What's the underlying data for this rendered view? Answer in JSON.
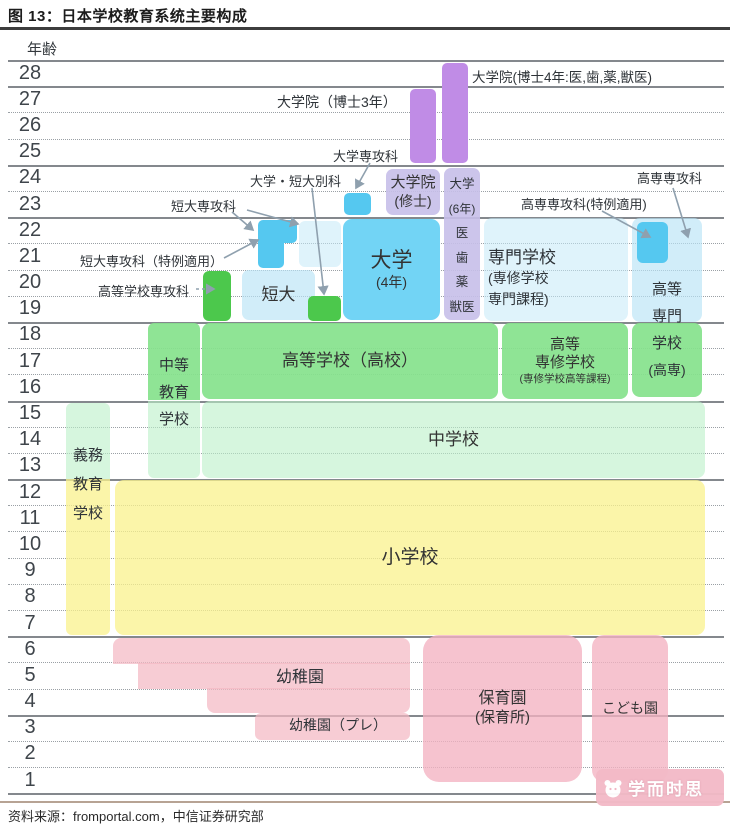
{
  "title": "图 13：日本学校教育系统主要构成",
  "source": "资料来源：fromportal.com，中信证券研究部",
  "axis_label": "年齢",
  "watermark": "学而时思",
  "diagram": {
    "palette": {
      "purple": "#c08ce6",
      "lavender": "rgba(198,191,233,0.9)",
      "blue": "#72d4f5",
      "blue_deep": "#55c8f0",
      "blue_pale": "rgba(184,228,246,0.65)",
      "blue_paler": "rgba(196,233,248,0.55)",
      "green_bright": "#4cc84c",
      "green_mid": "rgba(134,226,140,0.92)",
      "green_pale": "rgba(186,240,200,0.6)",
      "yellow": "rgba(250,242,140,0.75)",
      "pink": "rgba(244,184,196,0.72)",
      "pink2": "rgba(243,178,194,0.78)",
      "arrow": "#8fa0ae",
      "text": "#2e3338"
    },
    "rows": {
      "top": 60,
      "height": 26.19,
      "count": 28,
      "x1": 8,
      "x2": 724,
      "solid": [
        0,
        1,
        4,
        6,
        10,
        13,
        16,
        22,
        25,
        28
      ],
      "ages": [
        28,
        27,
        26,
        25,
        24,
        23,
        22,
        21,
        20,
        19,
        18,
        17,
        16,
        15,
        14,
        13,
        12,
        11,
        10,
        9,
        8,
        7,
        6,
        5,
        4,
        3,
        2,
        1
      ]
    },
    "blocks": [
      {
        "n": "block-doctoral-4yr",
        "x": 442,
        "y": 63,
        "w": 26,
        "h": 100,
        "c": "purple",
        "r": "5px"
      },
      {
        "n": "block-doctoral-3yr",
        "x": 410,
        "y": 89,
        "w": 26,
        "h": 74,
        "c": "purple",
        "r": "5px"
      },
      {
        "n": "block-grad-master",
        "x": 386,
        "y": 169,
        "w": 54,
        "h": 46,
        "c": "lavender",
        "r": "7px",
        "lines": [
          [
            "大学院",
            15
          ],
          [
            "(修士)",
            14
          ]
        ]
      },
      {
        "n": "block-univ-6yr",
        "x": 444,
        "y": 168,
        "w": 36,
        "h": 152,
        "c": "lavender",
        "r": "7px"
      },
      {
        "n": "block-univ-senkoka",
        "x": 344,
        "y": 193,
        "w": 27,
        "h": 22,
        "c": "blue_deep",
        "r": "5px"
      },
      {
        "n": "block-univ-4yr",
        "x": 343,
        "y": 219,
        "w": 97,
        "h": 101,
        "c": "blue",
        "r": "9px",
        "lines": [
          [
            "大学",
            21
          ],
          [
            "(4年)",
            14
          ]
        ]
      },
      {
        "n": "block-tandai-senkoka-upper",
        "x": 258,
        "y": 220,
        "w": 39,
        "h": 23,
        "c": "blue_deep",
        "r": "5px 5px 5px 0"
      },
      {
        "n": "block-tandai-senkoka-lower",
        "x": 258,
        "y": 242,
        "w": 26,
        "h": 26,
        "c": "blue_deep",
        "r": "0 0 5px 5px"
      },
      {
        "n": "block-univ-haze",
        "x": 299,
        "y": 221,
        "w": 42,
        "h": 46,
        "c": "blue_paler",
        "r": "6px"
      },
      {
        "n": "block-tandai",
        "x": 242,
        "y": 270,
        "w": 73,
        "h": 50,
        "c": "blue_pale",
        "r": "7px",
        "lines": [
          [
            "短大",
            17
          ]
        ]
      },
      {
        "n": "block-bekka-green",
        "x": 308,
        "y": 296,
        "w": 33,
        "h": 25,
        "c": "green_bright",
        "r": "5px"
      },
      {
        "n": "block-koko-senkoka-green",
        "x": 203,
        "y": 271,
        "w": 28,
        "h": 50,
        "c": "green_bright",
        "r": "6px"
      },
      {
        "n": "block-senmon-gakko",
        "x": 484,
        "y": 218,
        "w": 144,
        "h": 103,
        "c": "blue_paler",
        "r": "8px"
      },
      {
        "n": "block-kosen-upper",
        "x": 632,
        "y": 218,
        "w": 70,
        "h": 104,
        "c": "blue_pale",
        "r": "8px"
      },
      {
        "n": "block-kosen-senkoka",
        "x": 637,
        "y": 222,
        "w": 31,
        "h": 41,
        "c": "blue_deep",
        "r": "6px"
      },
      {
        "n": "block-kosen-green",
        "x": 632,
        "y": 323,
        "w": 70,
        "h": 74,
        "c": "green_mid",
        "r": "8px"
      },
      {
        "n": "block-chuto-upper",
        "x": 148,
        "y": 323,
        "w": 52,
        "h": 77,
        "c": "green_mid",
        "r": "6px 6px 0 0"
      },
      {
        "n": "block-chuto-lower",
        "x": 148,
        "y": 401,
        "w": 52,
        "h": 77,
        "c": "green_pale",
        "r": "0 0 6px 6px"
      },
      {
        "n": "block-koko",
        "x": 202,
        "y": 323,
        "w": 296,
        "h": 76,
        "c": "green_mid",
        "r": "8px",
        "lines": [
          [
            "高等学校（高校）",
            17
          ]
        ]
      },
      {
        "n": "block-koto-senshu",
        "x": 502,
        "y": 323,
        "w": 126,
        "h": 76,
        "c": "green_mid",
        "r": "8px",
        "lines": [
          [
            "高等",
            15
          ],
          [
            "専修学校",
            15
          ],
          [
            "(専修学校高等課程)",
            10.5
          ]
        ]
      },
      {
        "n": "block-chugakko",
        "x": 202,
        "y": 401,
        "w": 503,
        "h": 77,
        "c": "green_pale",
        "r": "8px",
        "lines": [
          [
            "中学校",
            17
          ]
        ]
      },
      {
        "n": "block-gimu-upper",
        "x": 66,
        "y": 403,
        "w": 44,
        "h": 76,
        "c": "green_pale",
        "r": "6px 6px 0 0"
      },
      {
        "n": "block-gimu-lower",
        "x": 66,
        "y": 479,
        "w": 44,
        "h": 156,
        "c": "yellow",
        "r": "0 0 6px 6px"
      },
      {
        "n": "block-shogakko",
        "x": 115,
        "y": 480,
        "w": 590,
        "h": 155,
        "c": "yellow",
        "r": "9px",
        "lines": [
          [
            "小学校",
            19
          ]
        ]
      },
      {
        "n": "block-yochien-row6",
        "x": 113,
        "y": 638,
        "w": 297,
        "h": 26,
        "c": "pink",
        "r": "8px 8px 0 0"
      },
      {
        "n": "block-yochien-row5",
        "x": 138,
        "y": 663,
        "w": 272,
        "h": 26,
        "c": "pink",
        "r": "0"
      },
      {
        "n": "block-yochien-row4",
        "x": 207,
        "y": 688,
        "w": 203,
        "h": 25,
        "c": "pink",
        "r": "0 0 8px 8px"
      },
      {
        "n": "block-yochien-pre",
        "x": 255,
        "y": 713,
        "w": 155,
        "h": 27,
        "c": "pink",
        "r": "6px"
      },
      {
        "n": "block-hoikuen",
        "x": 423,
        "y": 635,
        "w": 159,
        "h": 147,
        "c": "pink2",
        "r": "16px",
        "lines": [
          [
            "保育園",
            16
          ],
          [
            "(保育所)",
            15
          ]
        ]
      },
      {
        "n": "block-kodomoen",
        "x": 592,
        "y": 635,
        "w": 76,
        "h": 147,
        "c": "pink2",
        "r": "12px",
        "lines": [
          [
            "こども園",
            14
          ]
        ]
      }
    ],
    "labels": [
      {
        "n": "label-doctoral-4yr",
        "t": "大学院(博士4年:医,歯,薬,獣医)",
        "x": 472,
        "y": 66,
        "s": 13.5
      },
      {
        "n": "label-doctoral-3yr",
        "t": "大学院（博士3年）",
        "x": 277,
        "y": 92,
        "s": 14
      },
      {
        "n": "label-univ-senkoka",
        "t": "大学専攻科",
        "x": 333,
        "y": 146,
        "s": 13
      },
      {
        "n": "label-univ-tandai-bekka",
        "t": "大学・短大別科",
        "x": 250,
        "y": 171,
        "s": 13
      },
      {
        "n": "label-tandai-senkoka",
        "t": "短大専攻科",
        "x": 171,
        "y": 196,
        "s": 13
      },
      {
        "n": "label-tandai-tokurei",
        "t": "短大専攻科（特例適用）",
        "x": 80,
        "y": 251,
        "s": 13
      },
      {
        "n": "label-koko-senkoka",
        "t": "高等学校専攻科",
        "x": 98,
        "y": 281,
        "s": 13
      },
      {
        "n": "label-kosen-senkoka",
        "t": "高専専攻科",
        "x": 637,
        "y": 168,
        "s": 13
      },
      {
        "n": "label-kosen-tokurei",
        "t": "高専専攻科(特例適用)",
        "x": 521,
        "y": 194,
        "s": 13
      },
      {
        "n": "label-senmon-gakko",
        "lines": [
          [
            "専門学校",
            17
          ],
          [
            "(専修学校",
            14
          ],
          [
            "専門課程)",
            14
          ]
        ],
        "x": 488,
        "y": 247,
        "lh": 21,
        "align": "left"
      },
      {
        "n": "label-kosen",
        "lines": [
          [
            "高等",
            15
          ],
          [
            "専門",
            15
          ],
          [
            "学校",
            15
          ],
          [
            "(高専)",
            14
          ]
        ],
        "x": 632,
        "y": 276,
        "w": 70,
        "lh": 27,
        "align": "center"
      },
      {
        "n": "label-univ-6yr",
        "lines": [
          [
            "大学",
            12.5
          ],
          [
            "(6年)",
            12
          ],
          [
            "医",
            12.5
          ],
          [
            "歯",
            12.5
          ],
          [
            "薬",
            12.5
          ],
          [
            "獣医",
            12.5
          ]
        ],
        "x": 444,
        "y": 172,
        "w": 36,
        "lh": 24.5,
        "align": "center"
      },
      {
        "n": "label-chuto-kyoiku",
        "lines": [
          [
            "中等",
            15
          ],
          [
            "教育",
            15
          ],
          [
            "学校",
            15
          ]
        ],
        "x": 148,
        "y": 352,
        "w": 52,
        "lh": 27,
        "align": "center"
      },
      {
        "n": "label-gimu-kyoiku",
        "lines": [
          [
            "義務",
            15
          ],
          [
            "教育",
            15
          ],
          [
            "学校",
            15
          ]
        ],
        "x": 66,
        "y": 441,
        "w": 44,
        "lh": 29,
        "align": "center"
      },
      {
        "n": "label-yochien",
        "t": "幼稚園",
        "x": 230,
        "y": 663,
        "w": 140,
        "s": 16,
        "align": "center"
      },
      {
        "n": "label-yochien-pre",
        "t": "幼稚園（プレ）",
        "x": 262,
        "y": 715,
        "w": 152,
        "s": 14,
        "align": "center"
      }
    ],
    "arrows": [
      {
        "n": "arrow-univ-senkoka",
        "x1": 370,
        "y1": 163,
        "x2": 356,
        "y2": 188
      },
      {
        "n": "arrow-bekka",
        "x1": 312,
        "y1": 188,
        "x2": 324,
        "y2": 294
      },
      {
        "n": "arrow-tandai-senkoka-left",
        "x1": 232,
        "y1": 212,
        "x2": 253,
        "y2": 230
      },
      {
        "n": "arrow-tandai-senkoka-right",
        "x1": 247,
        "y1": 210,
        "x2": 298,
        "y2": 224
      },
      {
        "n": "arrow-tandai-tokurei",
        "x1": 224,
        "y1": 258,
        "x2": 258,
        "y2": 240
      },
      {
        "n": "arrow-koko-senkoka",
        "x1": 196,
        "y1": 289,
        "x2": 214,
        "y2": 289,
        "dash": true
      },
      {
        "n": "arrow-kosen-senkoka",
        "x1": 673,
        "y1": 188,
        "x2": 688,
        "y2": 237
      },
      {
        "n": "arrow-kosen-tokurei",
        "x1": 602,
        "y1": 211,
        "x2": 650,
        "y2": 237
      }
    ]
  }
}
